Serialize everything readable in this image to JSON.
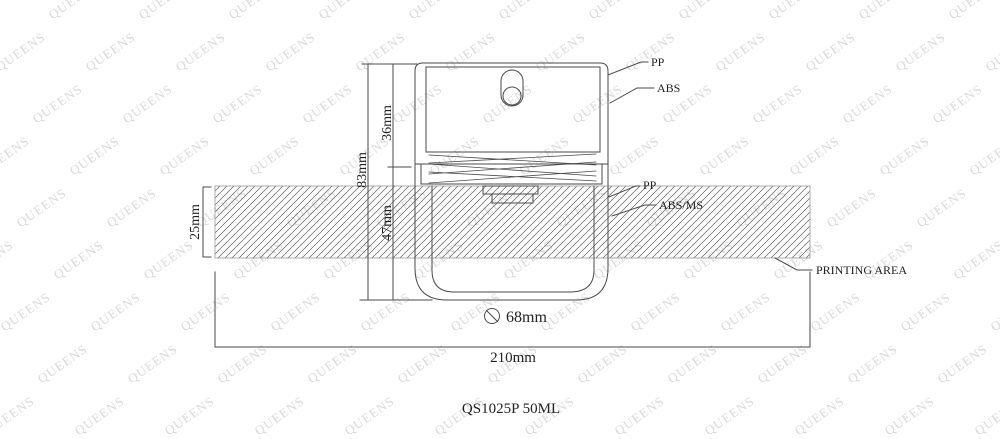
{
  "watermark": {
    "text": "QUEENS"
  },
  "drawing": {
    "title": "QS1025P 50ML",
    "printing_area_label": "PRINTING AREA",
    "materials": {
      "cap": "PP",
      "cap_inner": "ABS",
      "pump": "PP",
      "bottle": "ABS/MS"
    },
    "dimensions": {
      "total_height": "83mm",
      "cap_height": "36mm",
      "body_height": "47mm",
      "print_band_height": "25mm",
      "diameter": "68mm",
      "diameter_symbol": "⌀",
      "width": "210mm"
    }
  },
  "colors": {
    "line": "#4a4a4a",
    "hatch": "#5f5f5f",
    "band_edge": "#9a9a9a",
    "text": "#222222",
    "watermark": "#d9d9d9"
  }
}
